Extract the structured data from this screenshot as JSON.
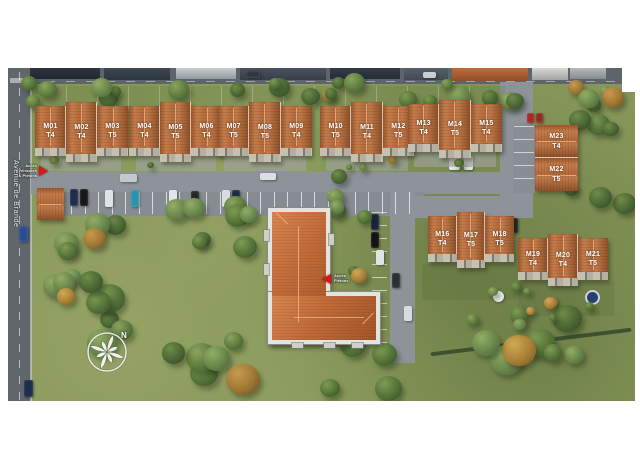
{
  "site_plan": {
    "street_name": "Avenue de Brande",
    "compass": {
      "north_label": "N"
    },
    "access_markers": [
      {
        "id": "vehicle-access",
        "direction": "right",
        "lines": [
          "Accès",
          "Véhicules",
          "& Piétons"
        ]
      },
      {
        "id": "pedestrian-access",
        "direction": "left",
        "lines": [
          "Accès",
          "Piétons"
        ]
      }
    ],
    "houses": [
      {
        "id": "M01",
        "type": "T4"
      },
      {
        "id": "M02",
        "type": "T4"
      },
      {
        "id": "M03",
        "type": "T5"
      },
      {
        "id": "M04",
        "type": "T4"
      },
      {
        "id": "M05",
        "type": "T5"
      },
      {
        "id": "M06",
        "type": "T4"
      },
      {
        "id": "M07",
        "type": "T5"
      },
      {
        "id": "M08",
        "type": "T5"
      },
      {
        "id": "M09",
        "type": "T4"
      },
      {
        "id": "M10",
        "type": "T5"
      },
      {
        "id": "M11",
        "type": "T4"
      },
      {
        "id": "M12",
        "type": "T5"
      },
      {
        "id": "M13",
        "type": "T4"
      },
      {
        "id": "M14",
        "type": "T5"
      },
      {
        "id": "M15",
        "type": "T4"
      },
      {
        "id": "M16",
        "type": "T4"
      },
      {
        "id": "M17",
        "type": "T5"
      },
      {
        "id": "M18",
        "type": "T5"
      },
      {
        "id": "M19",
        "type": "T4"
      },
      {
        "id": "M20",
        "type": "T4"
      },
      {
        "id": "M21",
        "type": "T5"
      },
      {
        "id": "M22",
        "type": "T5"
      },
      {
        "id": "M23",
        "type": "T4"
      }
    ],
    "colors": {
      "roof_terracotta": "#b0693a",
      "central_roof": "#c06a38",
      "grass": "#87975a",
      "road_grey": "#8e939a",
      "accent_red": "#e01414",
      "label_text": "#ffffff"
    }
  }
}
